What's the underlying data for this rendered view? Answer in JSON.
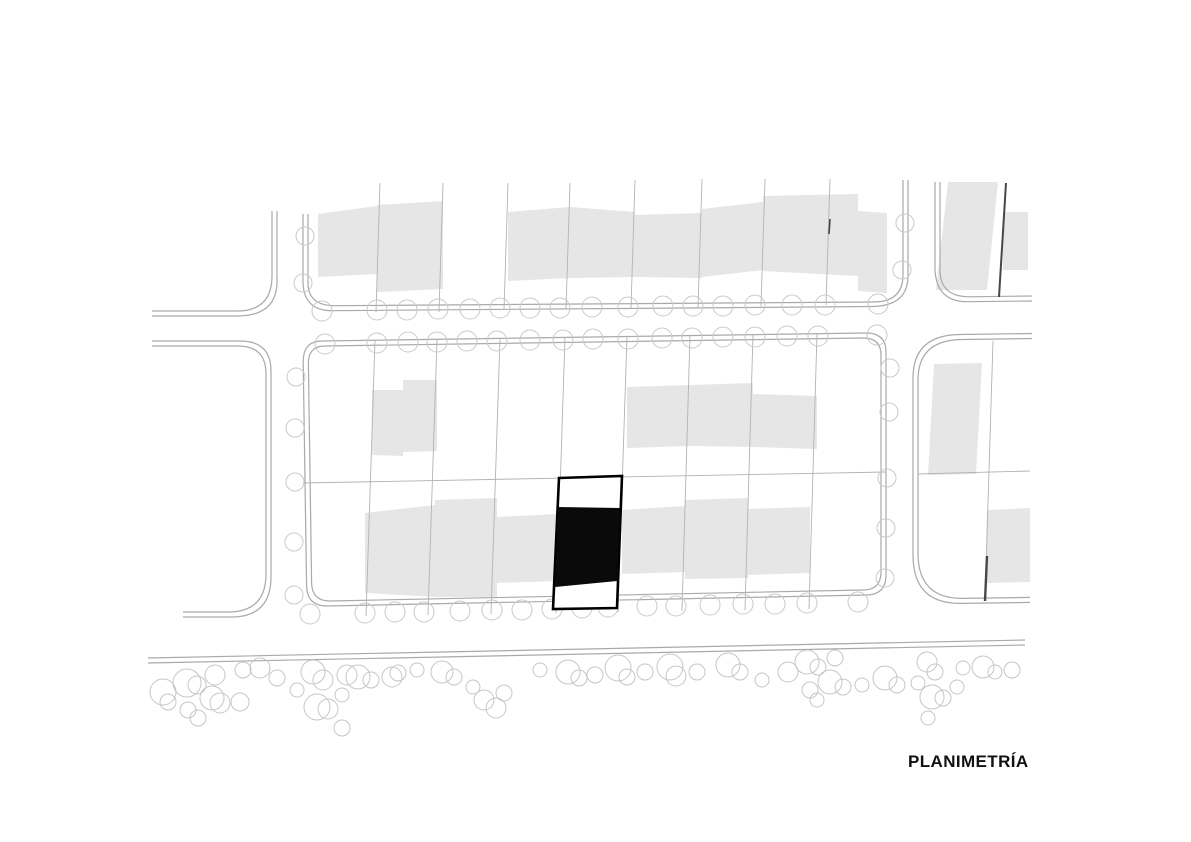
{
  "page": {
    "title_label": "PLANIMETRÍA",
    "background": "#ffffff"
  },
  "palette": {
    "building_gray": "#e6e6e6",
    "street_line": "#a9a9a9",
    "lot_line": "#b3b3b3",
    "dark_line": "#474747",
    "tree_line": "#c9c9c9",
    "highlight_black": "#0a0a0a",
    "lot_white": "#ffffff"
  },
  "plan": {
    "viewbox": "0 0 1191 842",
    "width": "1191",
    "height": "842",
    "layers": [
      {
        "key": "buildings",
        "tag": "polygon",
        "item_name": "building-footprint",
        "defaults": {
          "fill": "#e6e6e6",
          "stroke": "none"
        }
      },
      {
        "key": "streets",
        "tag": "path",
        "item_name": "street-line",
        "defaults": {
          "fill": "none",
          "stroke": "#a9a9a9",
          "stroke-width": "1.2"
        }
      },
      {
        "key": "lot_lines",
        "tag": "line",
        "item_name": "lot-line",
        "defaults": {
          "stroke": "#b3b3b3",
          "stroke-width": "0.9"
        }
      },
      {
        "key": "dark_lines",
        "tag": "line",
        "item_name": "dark-lot-line",
        "defaults": {
          "stroke": "#474747",
          "stroke-width": "2"
        }
      },
      {
        "key": "row_trees",
        "tag": "circle",
        "item_name": "street-tree",
        "defaults": {
          "fill": "none",
          "stroke": "#c9c9c9",
          "stroke-width": "1",
          "r": "10"
        }
      },
      {
        "key": "scatter_trees",
        "tag": "circle",
        "item_name": "park-tree",
        "defaults": {
          "fill": "none",
          "stroke": "#c6c6c6",
          "stroke-width": "1"
        }
      },
      {
        "key": "highlight",
        "tag": "polygon",
        "item_name": "highlight-shape",
        "defaults": {}
      }
    ],
    "buildings": [
      {
        "points": "318,214 377,206 377,274 318,277"
      },
      {
        "points": "377,205 443,201 443,289 377,292"
      },
      {
        "points": "508,212 570,207 570,278 508,281"
      },
      {
        "points": "570,207 635,212 635,277 570,278"
      },
      {
        "points": "635,215 702,213 702,278 635,277"
      },
      {
        "points": "702,209 763,202 763,270 702,277"
      },
      {
        "points": "763,196 858,194 858,276 763,271"
      },
      {
        "points": "858,211 887,213 887,293 858,291"
      },
      {
        "points": "948,182 998,182 987,290 936,290"
      },
      {
        "points": "1003,212 1028,212 1028,270 1003,270"
      },
      {
        "points": "372,390 403,390 403,380 437,380 437,451 403,452 403,456 372,455"
      },
      {
        "points": "627,387 690,385 690,446 627,448"
      },
      {
        "points": "690,385 753,383 753,447 690,446"
      },
      {
        "points": "753,394 817,396 817,449 753,447"
      },
      {
        "points": "365,513 435,505 435,597 365,593"
      },
      {
        "points": "435,500 497,498 497,597 435,597"
      },
      {
        "points": "497,517 557,514 557,581 497,583"
      },
      {
        "points": "622,510 685,506 685,572 622,574"
      },
      {
        "points": "685,500 748,498 748,578 685,579"
      },
      {
        "points": "748,509 810,507 810,573 748,575"
      },
      {
        "points": "934,364 982,363 976,474 928,475"
      },
      {
        "points": "987,510 1030,508 1030,582 985,583"
      }
    ],
    "streets": [
      {
        "name": "street-nw-corner-outer",
        "d": "M152,311 H237 Q272,311 272,276 V211"
      },
      {
        "name": "street-nw-corner-inner",
        "d": "M152,316 H237 Q277,316 277,281 V211"
      },
      {
        "name": "street-west-block-inner",
        "d": "M152,346 H238 Q266,346 266,374 V574 Q266,612 228,612 H183"
      },
      {
        "name": "street-west-block-outer",
        "d": "M152,341 H240 Q271,341 271,371 V577 Q271,617 231,617 H183"
      },
      {
        "name": "street-main-block-outer",
        "d": "M322,341 L866,333 Q886,333 886,352 L886,575 Q886,595 866,595 L327,606 Q307,606 306.6,586 L303.2,362 Q303,341 322,341 Z"
      },
      {
        "name": "street-main-block-inner",
        "d": "M325,346 L863,338 Q881,338 881,355 L881,572 Q881,590 863,590 L330,601 Q312,601 311.6,583 L308.4,364 Q308,346 325,346 Z"
      },
      {
        "name": "street-north-block-outer",
        "d": "M303,214 V281 Q303,311 333,310.7 L872,306.5 Q908,306 908,276 V180"
      },
      {
        "name": "street-north-block-inner",
        "d": "M308,214 V283 Q308,306 336,305.7 L874,302 Q903,301.7 903,275 V180"
      },
      {
        "name": "street-ne-corner-outer",
        "d": "M935,182 V267 Q935,302 968,301.7 L1032,301"
      },
      {
        "name": "street-ne-corner-inner",
        "d": "M940,182 V270 Q940,297 970,296.8 L1032,296"
      },
      {
        "name": "street-east-block-outer",
        "d": "M1032,333.5 L960,334.5 Q913,335 913,378 V555 Q913,604 961,603.4 L1030,602.4"
      },
      {
        "name": "street-east-block-inner",
        "d": "M1032,338.5 L962,339.5 Q918,340 918,380 V553 Q918,599 963,598.4 L1030,597.4"
      },
      {
        "name": "street-south-upper",
        "d": "M148,658 L1025,640"
      },
      {
        "name": "street-south-lower",
        "d": "M148,663 L1025,645"
      }
    ],
    "lot_lines": [
      {
        "x1": 380,
        "y1": 183,
        "x2": 376,
        "y2": 312
      },
      {
        "x1": 443,
        "y1": 183,
        "x2": 439,
        "y2": 312
      },
      {
        "x1": 508,
        "y1": 183,
        "x2": 504,
        "y2": 310
      },
      {
        "x1": 570,
        "y1": 183,
        "x2": 566,
        "y2": 309
      },
      {
        "x1": 635,
        "y1": 180,
        "x2": 631,
        "y2": 308
      },
      {
        "x1": 702,
        "y1": 179,
        "x2": 698,
        "y2": 307
      },
      {
        "x1": 765,
        "y1": 179,
        "x2": 761,
        "y2": 306
      },
      {
        "x1": 830,
        "y1": 179,
        "x2": 826,
        "y2": 305
      },
      {
        "x1": 375,
        "y1": 340,
        "x2": 366,
        "y2": 616
      },
      {
        "x1": 437,
        "y1": 339,
        "x2": 428,
        "y2": 615
      },
      {
        "x1": 500,
        "y1": 338,
        "x2": 491,
        "y2": 614
      },
      {
        "x1": 565,
        "y1": 337,
        "x2": 556,
        "y2": 613
      },
      {
        "x1": 627,
        "y1": 336,
        "x2": 618,
        "y2": 612
      },
      {
        "x1": 690,
        "y1": 335,
        "x2": 682,
        "y2": 611
      },
      {
        "x1": 753,
        "y1": 334,
        "x2": 745,
        "y2": 610
      },
      {
        "x1": 817,
        "y1": 333,
        "x2": 809,
        "y2": 609
      },
      {
        "x1": 303,
        "y1": 483,
        "x2": 886,
        "y2": 472
      },
      {
        "x1": 918,
        "y1": 474,
        "x2": 1030,
        "y2": 471
      },
      {
        "x1": 993,
        "y1": 341,
        "x2": 985,
        "y2": 601
      }
    ],
    "dark_lines": [
      {
        "x1": 1006,
        "y1": 183,
        "x2": 999,
        "y2": 297
      },
      {
        "x1": 987,
        "y1": 556,
        "x2": 985,
        "y2": 601,
        "stroke-width": "2.4"
      },
      {
        "x1": 830,
        "y1": 219,
        "x2": 829,
        "y2": 234,
        "stroke-width": "1.6"
      }
    ],
    "row_trees": [
      {
        "cx": 322,
        "cy": 311
      },
      {
        "cx": 377,
        "cy": 310
      },
      {
        "cx": 407,
        "cy": 310
      },
      {
        "cx": 438,
        "cy": 309
      },
      {
        "cx": 470,
        "cy": 309
      },
      {
        "cx": 500,
        "cy": 308
      },
      {
        "cx": 530,
        "cy": 308
      },
      {
        "cx": 560,
        "cy": 308
      },
      {
        "cx": 592,
        "cy": 307
      },
      {
        "cx": 628,
        "cy": 307
      },
      {
        "cx": 663,
        "cy": 306
      },
      {
        "cx": 693,
        "cy": 306
      },
      {
        "cx": 723,
        "cy": 306
      },
      {
        "cx": 755,
        "cy": 305
      },
      {
        "cx": 792,
        "cy": 305
      },
      {
        "cx": 825,
        "cy": 305
      },
      {
        "cx": 878,
        "cy": 304
      },
      {
        "cx": 325,
        "cy": 344
      },
      {
        "cx": 377,
        "cy": 343
      },
      {
        "cx": 408,
        "cy": 342
      },
      {
        "cx": 437,
        "cy": 342
      },
      {
        "cx": 467,
        "cy": 341
      },
      {
        "cx": 497,
        "cy": 341
      },
      {
        "cx": 530,
        "cy": 340
      },
      {
        "cx": 563,
        "cy": 340
      },
      {
        "cx": 593,
        "cy": 339
      },
      {
        "cx": 628,
        "cy": 339
      },
      {
        "cx": 662,
        "cy": 338
      },
      {
        "cx": 692,
        "cy": 338
      },
      {
        "cx": 723,
        "cy": 337
      },
      {
        "cx": 755,
        "cy": 337
      },
      {
        "cx": 787,
        "cy": 336
      },
      {
        "cx": 818,
        "cy": 336
      },
      {
        "cx": 877,
        "cy": 335
      },
      {
        "cx": 310,
        "cy": 614
      },
      {
        "cx": 365,
        "cy": 613
      },
      {
        "cx": 395,
        "cy": 612
      },
      {
        "cx": 424,
        "cy": 612
      },
      {
        "cx": 460,
        "cy": 611
      },
      {
        "cx": 492,
        "cy": 610
      },
      {
        "cx": 522,
        "cy": 610
      },
      {
        "cx": 552,
        "cy": 609
      },
      {
        "cx": 582,
        "cy": 608
      },
      {
        "cx": 608,
        "cy": 607
      },
      {
        "cx": 647,
        "cy": 606
      },
      {
        "cx": 676,
        "cy": 606
      },
      {
        "cx": 710,
        "cy": 605
      },
      {
        "cx": 743,
        "cy": 604
      },
      {
        "cx": 775,
        "cy": 604
      },
      {
        "cx": 807,
        "cy": 603
      },
      {
        "cx": 858,
        "cy": 602
      },
      {
        "cx": 296,
        "cy": 377,
        "r": 9
      },
      {
        "cx": 295,
        "cy": 428,
        "r": 9
      },
      {
        "cx": 295,
        "cy": 482,
        "r": 9
      },
      {
        "cx": 294,
        "cy": 542,
        "r": 9
      },
      {
        "cx": 294,
        "cy": 595,
        "r": 9
      },
      {
        "cx": 890,
        "cy": 368,
        "r": 9
      },
      {
        "cx": 889,
        "cy": 412,
        "r": 9
      },
      {
        "cx": 887,
        "cy": 478,
        "r": 9
      },
      {
        "cx": 886,
        "cy": 528,
        "r": 9
      },
      {
        "cx": 885,
        "cy": 578,
        "r": 9
      },
      {
        "cx": 305,
        "cy": 236,
        "r": 9
      },
      {
        "cx": 303,
        "cy": 283,
        "r": 9
      },
      {
        "cx": 905,
        "cy": 223,
        "r": 9
      },
      {
        "cx": 902,
        "cy": 270,
        "r": 9
      }
    ],
    "scatter_trees": [
      {
        "cx": 163,
        "cy": 692,
        "r": 13
      },
      {
        "cx": 168,
        "cy": 702,
        "r": 8
      },
      {
        "cx": 187,
        "cy": 683,
        "r": 14
      },
      {
        "cx": 197,
        "cy": 685,
        "r": 9
      },
      {
        "cx": 188,
        "cy": 710,
        "r": 8
      },
      {
        "cx": 198,
        "cy": 718,
        "r": 8
      },
      {
        "cx": 215,
        "cy": 675,
        "r": 10
      },
      {
        "cx": 212,
        "cy": 698,
        "r": 12
      },
      {
        "cx": 220,
        "cy": 703,
        "r": 10
      },
      {
        "cx": 240,
        "cy": 702,
        "r": 9
      },
      {
        "cx": 243,
        "cy": 670,
        "r": 8
      },
      {
        "cx": 260,
        "cy": 668,
        "r": 10
      },
      {
        "cx": 277,
        "cy": 678,
        "r": 8
      },
      {
        "cx": 297,
        "cy": 690,
        "r": 7
      },
      {
        "cx": 313,
        "cy": 672,
        "r": 12
      },
      {
        "cx": 323,
        "cy": 680,
        "r": 10
      },
      {
        "cx": 342,
        "cy": 695,
        "r": 7
      },
      {
        "cx": 317,
        "cy": 707,
        "r": 13
      },
      {
        "cx": 328,
        "cy": 709,
        "r": 10
      },
      {
        "cx": 342,
        "cy": 728,
        "r": 8
      },
      {
        "cx": 347,
        "cy": 675,
        "r": 10
      },
      {
        "cx": 358,
        "cy": 677,
        "r": 12
      },
      {
        "cx": 371,
        "cy": 680,
        "r": 8
      },
      {
        "cx": 392,
        "cy": 677,
        "r": 10
      },
      {
        "cx": 398,
        "cy": 673,
        "r": 8
      },
      {
        "cx": 417,
        "cy": 670,
        "r": 7
      },
      {
        "cx": 442,
        "cy": 672,
        "r": 11
      },
      {
        "cx": 454,
        "cy": 677,
        "r": 8
      },
      {
        "cx": 473,
        "cy": 687,
        "r": 7
      },
      {
        "cx": 484,
        "cy": 700,
        "r": 10
      },
      {
        "cx": 496,
        "cy": 708,
        "r": 10
      },
      {
        "cx": 504,
        "cy": 693,
        "r": 8
      },
      {
        "cx": 540,
        "cy": 670,
        "r": 7
      },
      {
        "cx": 568,
        "cy": 672,
        "r": 12
      },
      {
        "cx": 579,
        "cy": 678,
        "r": 8
      },
      {
        "cx": 595,
        "cy": 675,
        "r": 8
      },
      {
        "cx": 618,
        "cy": 668,
        "r": 13
      },
      {
        "cx": 627,
        "cy": 677,
        "r": 8
      },
      {
        "cx": 645,
        "cy": 672,
        "r": 8
      },
      {
        "cx": 670,
        "cy": 667,
        "r": 13
      },
      {
        "cx": 676,
        "cy": 676,
        "r": 10
      },
      {
        "cx": 697,
        "cy": 672,
        "r": 8
      },
      {
        "cx": 728,
        "cy": 665,
        "r": 12
      },
      {
        "cx": 740,
        "cy": 672,
        "r": 8
      },
      {
        "cx": 762,
        "cy": 680,
        "r": 7
      },
      {
        "cx": 788,
        "cy": 672,
        "r": 10
      },
      {
        "cx": 807,
        "cy": 662,
        "r": 12
      },
      {
        "cx": 818,
        "cy": 667,
        "r": 8
      },
      {
        "cx": 835,
        "cy": 658,
        "r": 8
      },
      {
        "cx": 830,
        "cy": 682,
        "r": 12
      },
      {
        "cx": 843,
        "cy": 687,
        "r": 8
      },
      {
        "cx": 810,
        "cy": 690,
        "r": 8
      },
      {
        "cx": 817,
        "cy": 700,
        "r": 7
      },
      {
        "cx": 862,
        "cy": 685,
        "r": 7
      },
      {
        "cx": 885,
        "cy": 678,
        "r": 12
      },
      {
        "cx": 897,
        "cy": 685,
        "r": 8
      },
      {
        "cx": 918,
        "cy": 683,
        "r": 7
      },
      {
        "cx": 927,
        "cy": 662,
        "r": 10
      },
      {
        "cx": 935,
        "cy": 672,
        "r": 8
      },
      {
        "cx": 932,
        "cy": 697,
        "r": 12
      },
      {
        "cx": 943,
        "cy": 698,
        "r": 8
      },
      {
        "cx": 928,
        "cy": 718,
        "r": 7
      },
      {
        "cx": 957,
        "cy": 687,
        "r": 7
      },
      {
        "cx": 963,
        "cy": 668,
        "r": 7
      },
      {
        "cx": 983,
        "cy": 667,
        "r": 11
      },
      {
        "cx": 995,
        "cy": 672,
        "r": 7
      },
      {
        "cx": 1012,
        "cy": 670,
        "r": 8
      }
    ],
    "highlight": [
      {
        "name": "highlighted-lot",
        "points": "559,478 622,476 617,608 553,609",
        "fill": "#ffffff",
        "stroke": "#000000",
        "stroke-width": "2.6"
      },
      {
        "name": "highlighted-building",
        "points": "558,507 620,508 617,581 555,587",
        "fill": "#0a0a0a",
        "stroke": "none"
      }
    ]
  }
}
